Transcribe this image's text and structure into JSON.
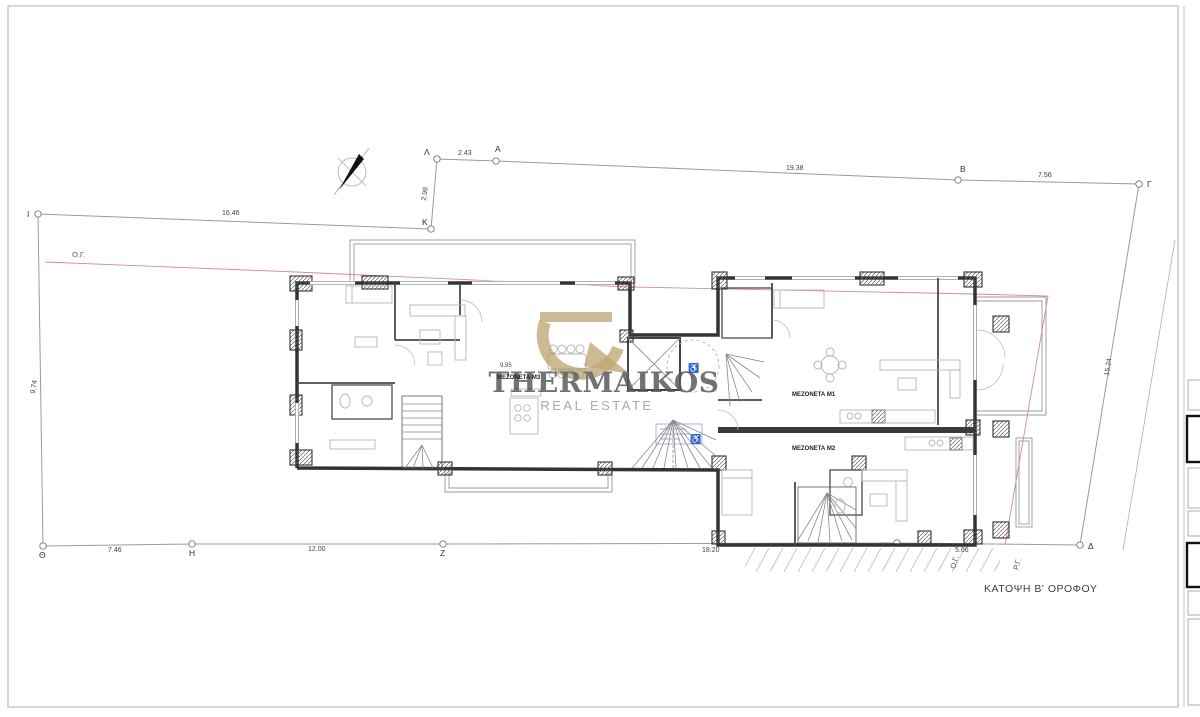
{
  "drawing": {
    "title": "ΚΑΤΟΨΗ Β' ΟΡΟΦΟΥ"
  },
  "logo": {
    "brand": "THERMAIKOS",
    "subtitle": "REAL ESTATE",
    "gold": "#b49a5f",
    "text_gray": "#595a5e"
  },
  "site": {
    "regulation_line_label": "Ο.Γ.",
    "regulation_line_label_2": "Ο.Γ.",
    "building_line_label": "Ρ.Γ.",
    "vertices": {
      "lambda": "Λ",
      "alpha": "A",
      "beta": "B",
      "gamma": "Γ",
      "delta": "Δ",
      "zeta": "Z",
      "eta": "H",
      "theta": "Θ",
      "iota": "I",
      "kappa": "K"
    },
    "dimensions": {
      "lambda_alpha": "2.43",
      "alpha_beta": "19.38",
      "beta_gamma": "7.56",
      "gamma_delta": "15.24",
      "delta_offset": "5.66",
      "building_front": "18.20",
      "zeta_eta": "12.00",
      "eta_theta": "7.46",
      "theta_iota": "9.74",
      "iota_kappa": "16.46",
      "kappa_lambda": "2.98",
      "m3_width": "9.95"
    }
  },
  "units": {
    "m1": "ΜΕΖΟΝΕΤΑ Μ1",
    "m2": "ΜΕΖΟΝΕΤΑ Μ2",
    "m3": "ΜΕΖΟΝΕΤΑ Μ3"
  },
  "icons": {
    "wheelchair": "♿"
  }
}
